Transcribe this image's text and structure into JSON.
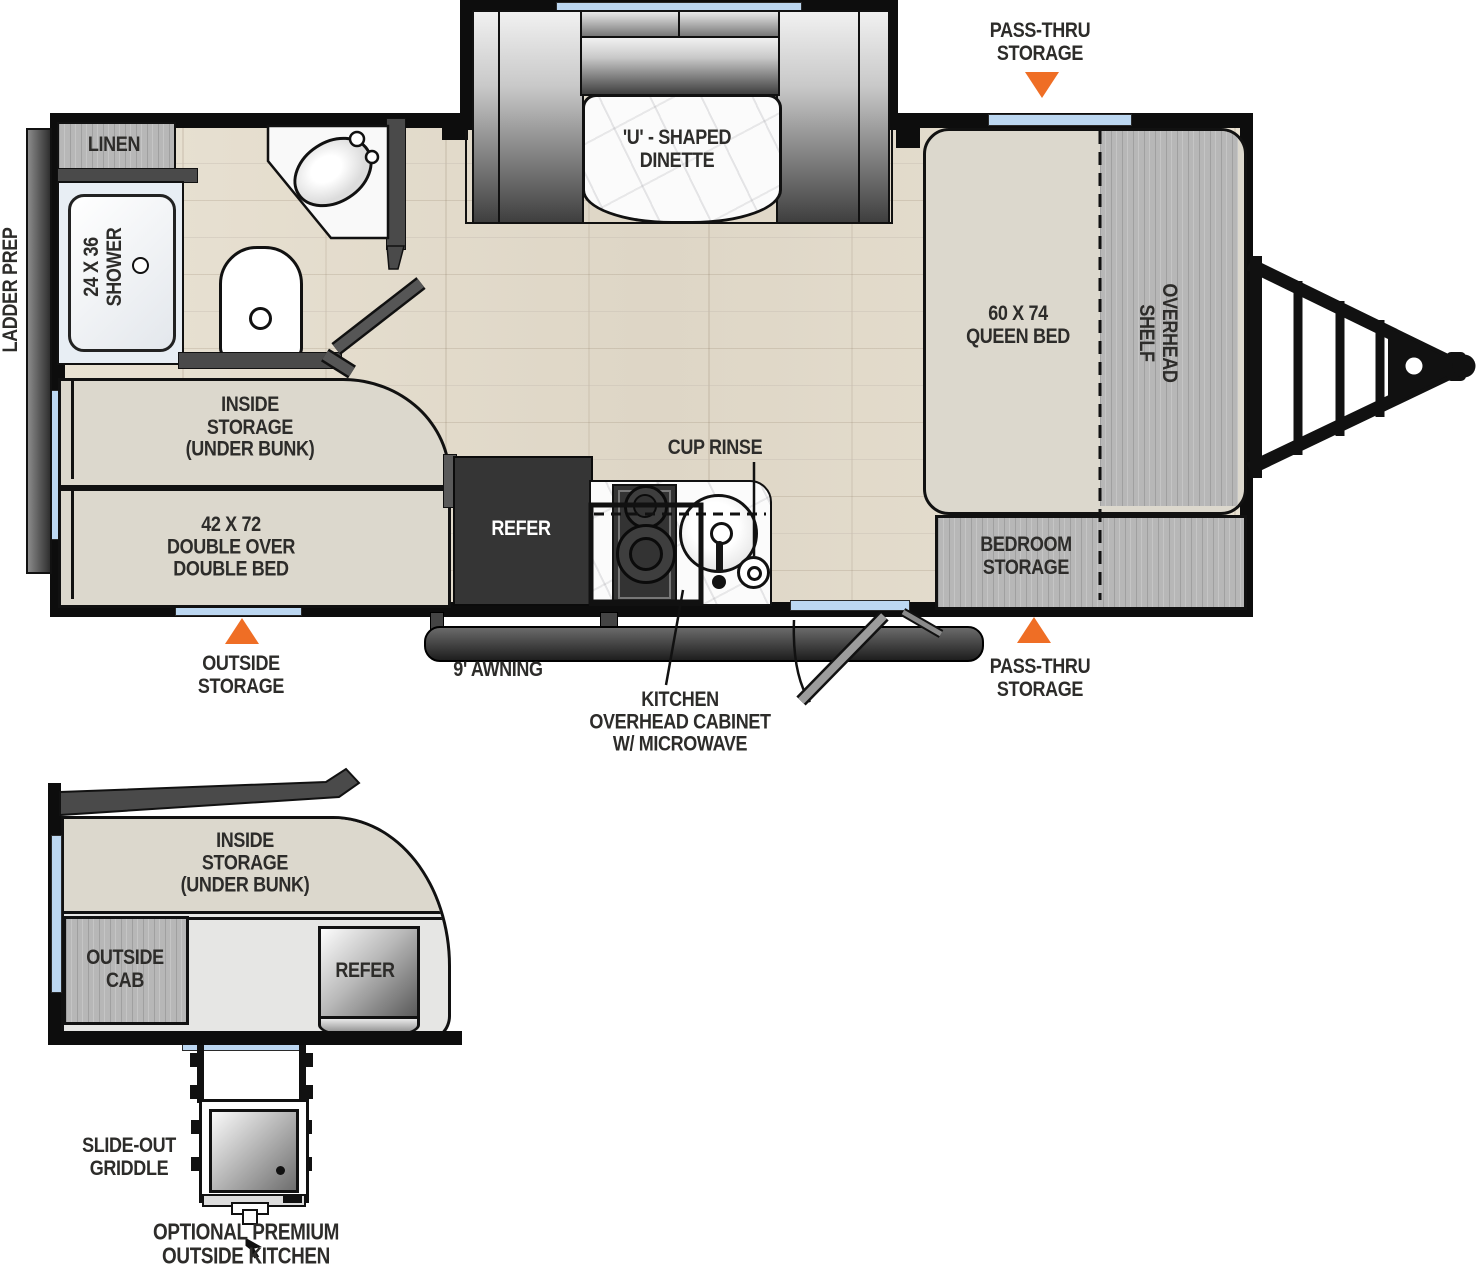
{
  "colors": {
    "accent_orange": "#EF6E25",
    "window_blue": "#BCD7F1",
    "wall_black": "#0D0D0D",
    "label_text": "#2D2C2A"
  },
  "labels": {
    "ladder_prep": "LADDER PREP",
    "linen": "LINEN",
    "shower": "24 X 36\nSHOWER",
    "inside_storage": "INSIDE\nSTORAGE\n(UNDER BUNK)",
    "double_bed": "42 X 72\nDOUBLE OVER\nDOUBLE BED",
    "refer": "REFER",
    "dinette": "'U' - SHAPED\nDINETTE",
    "cup_rinse": "CUP RINSE",
    "queen_bed": "60 X 74\nQUEEN BED",
    "overhead_shelf": "OVERHEAD\nSHELF",
    "bedroom_storage": "BEDROOM\nSTORAGE",
    "pass_thru_top": "PASS-THRU\nSTORAGE",
    "pass_thru_bottom": "PASS-THRU\nSTORAGE",
    "outside_storage": "OUTSIDE\nSTORAGE",
    "awning": "9' AWNING",
    "kitchen_overhead_cabinet": "KITCHEN\nOVERHEAD CABINET\nW/ MICROWAVE"
  },
  "outside_kitchen": {
    "inside_storage": "INSIDE\nSTORAGE\n(UNDER BUNK)",
    "outside_cab": "OUTSIDE\nCAB",
    "refer": "REFER",
    "slide_out_griddle": "SLIDE-OUT\nGRIDDLE",
    "optional_premium": "OPTIONAL PREMIUM\nOUTSIDE KITCHEN"
  }
}
